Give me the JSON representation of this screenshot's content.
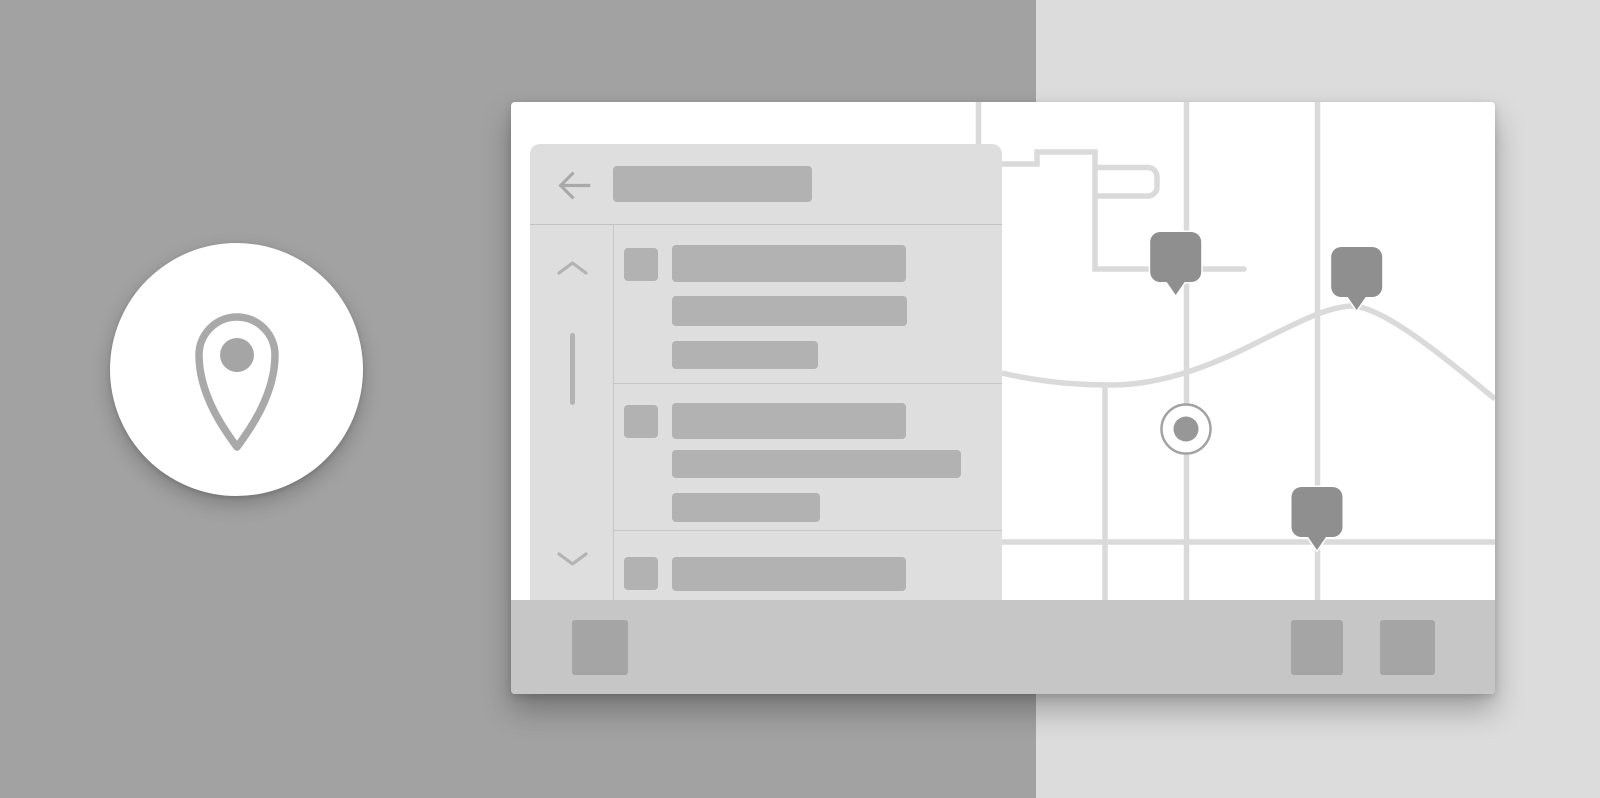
{
  "badge": {
    "icon": "location-pin"
  },
  "window": {
    "sidebar": {
      "back_icon": "arrow-left",
      "header_placeholder": {
        "w": 199,
        "h": 36
      },
      "scrollbar": {
        "up_icon": "chevron-up",
        "down_icon": "chevron-down"
      },
      "items": [
        {
          "height": 159,
          "checkbox": {
            "top": 23
          },
          "bars": [
            {
              "top": 20,
              "w": 234,
              "h": 37
            },
            {
              "top": 71,
              "w": 235,
              "h": 30
            },
            {
              "top": 116,
              "w": 146,
              "h": 28
            }
          ]
        },
        {
          "height": 147,
          "checkbox": {
            "top": 21
          },
          "bars": [
            {
              "top": 19,
              "w": 234,
              "h": 36
            },
            {
              "top": 66,
              "w": 289,
              "h": 28
            },
            {
              "top": 109,
              "w": 148,
              "h": 29
            }
          ]
        },
        {
          "height": 69,
          "checkbox": {
            "top": 26
          },
          "bars": [
            {
              "top": 26,
              "w": 234,
              "h": 34
            }
          ]
        }
      ]
    },
    "map": {
      "markers": [
        {
          "type": "pin",
          "x": 664.7,
          "tip": 193
        },
        {
          "type": "pin",
          "x": 845.7,
          "tip": 208
        },
        {
          "type": "pin",
          "x": 806,
          "tip": 448
        },
        {
          "type": "dot",
          "x": 675,
          "y": 327
        }
      ]
    },
    "toolbar": {
      "buttons": [
        {
          "x": 61,
          "w": 56
        },
        {
          "x": 780,
          "w": 52
        },
        {
          "x": 869,
          "w": 55
        }
      ]
    }
  },
  "colors": {
    "bg_left": "#a2a2a2",
    "bg_right": "#dcdcdc",
    "card": "#ffffff",
    "panel": "#dedede",
    "skeleton": "#b2b2b2",
    "divider": "#c6c6c6",
    "road": "#dadada",
    "pin_marker": "#8f8f8f",
    "dot_ring": "#a2a2a2",
    "dot_fill": "#979797",
    "bottom_bar": "#c6c6c6",
    "bottom_button": "#a5a5a5",
    "icon_gray": "#a9a9a9",
    "badge_bg": "#ffffff"
  }
}
